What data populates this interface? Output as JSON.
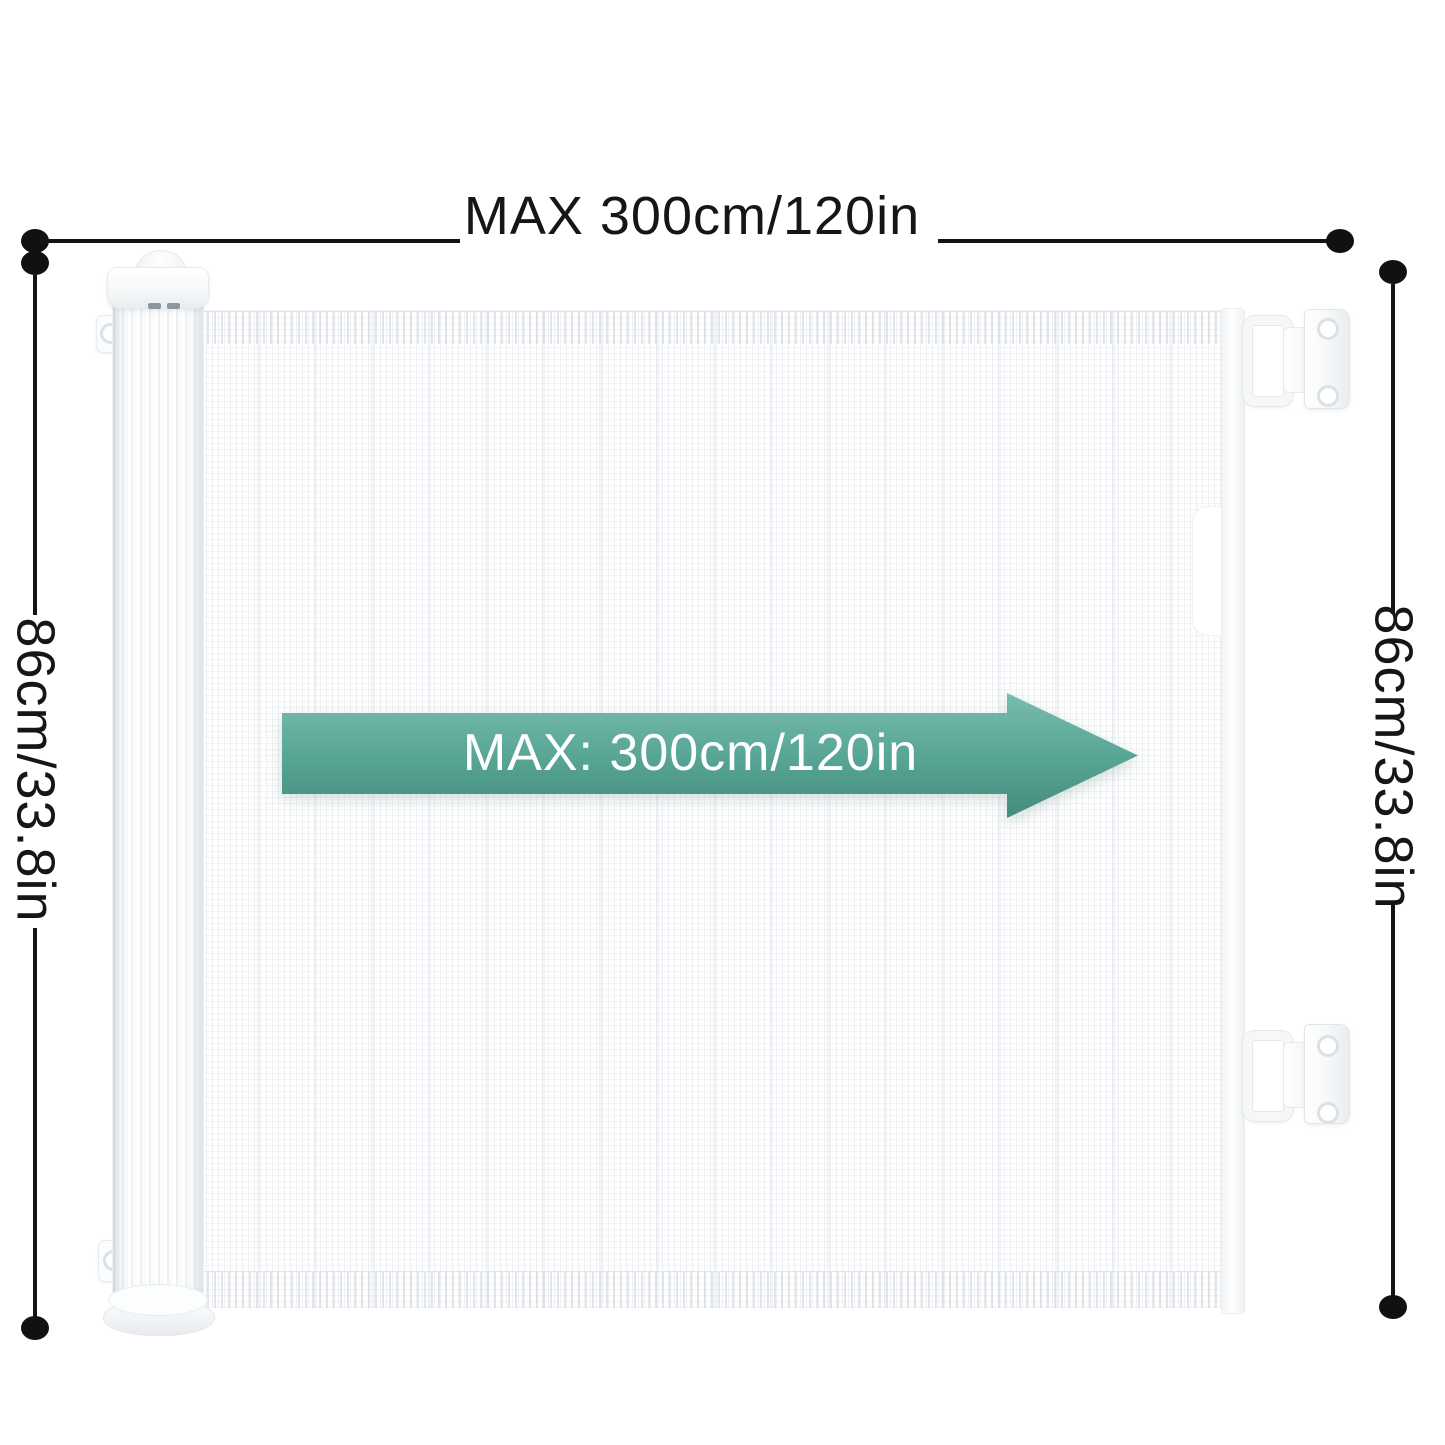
{
  "annotations": {
    "top_width_label": "MAX 300cm/120in",
    "left_height_label": "86cm/33.8in",
    "right_height_label": "86cm/33.8in",
    "arrow_label": "MAX: 300cm/120in"
  },
  "colors": {
    "dimension_line": "#141414",
    "arrow_gradient_top": "#79bcae",
    "arrow_gradient_bottom": "#458c7c",
    "arrow_text": "#ffffff",
    "gate_body": "#ffffff"
  }
}
